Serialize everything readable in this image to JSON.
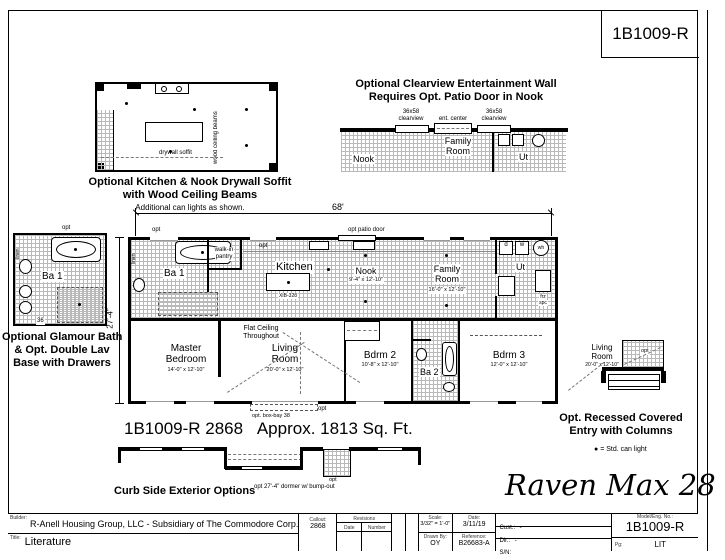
{
  "style": {
    "ink": "#000000",
    "paper": "#ffffff",
    "grid_line": "#b9b9b9"
  },
  "sheet": {
    "model_number": "1B1009-R",
    "series_name": "Raven Max 28"
  },
  "kitchen_detail": {
    "caption_1": "Optional Kitchen & Nook Drywall Soffit",
    "caption_2": "with Wood Ceiling Beams",
    "caption_3": "Additional can lights as shown.",
    "wood_beams": "wood ceiling beams",
    "drywall_soffit": "drywall soffit"
  },
  "ent_wall_detail": {
    "title_1": "Optional Clearview Entertainment Wall",
    "title_2": "Requires Opt. Patio Door in Nook",
    "clearview_l1": "36x58",
    "clearview_l2": "clearview",
    "ent_center": "ent. center",
    "clearview_r1": "36x58",
    "clearview_r2": "clearview",
    "family_1": "Family",
    "family_2": "Room",
    "nook": "Nook",
    "ut": "Ut"
  },
  "bath_detail": {
    "caption_1": "Optional Glamour Bath",
    "caption_2": "& Opt. Double Lav",
    "caption_3": "Base with Drawers",
    "room": "Ba 1",
    "opt": "opt",
    "linen": "linen",
    "dim_36": "36"
  },
  "plan": {
    "dim_width": "68'",
    "dim_depth": "27'-4\"",
    "opt_patio_door": "opt patio door",
    "opt_left": "opt",
    "opt_kitchen": "opt",
    "opt_front": "opt",
    "box_bay": "opt. box-bay 38",
    "flat_ceiling_1": "Flat Ceiling",
    "flat_ceiling_2": "Throughout",
    "ba1": "Ba 1",
    "linen": "linen",
    "pantry_1": "walk-in",
    "pantry_2": "pantry",
    "kitchen": "Kitchen",
    "island": "XIB-328",
    "nook": "Nook",
    "nook_dims": "9'-4\" x 12'-10\"",
    "family_1": "Family",
    "family_2": "Room",
    "family_dims": "16'-0\" x 12'-10\"",
    "ut": "Ut",
    "dryer": "d",
    "washer": "w",
    "water_heater": "wh",
    "frz_1": "frz",
    "frz_2": "spc",
    "master_1": "Master",
    "master_2": "Bedroom",
    "master_dims": "14'-0\" x 12'-10\"",
    "living_1": "Living",
    "living_2": "Room",
    "living_dims": "20'-0\" x 12'-10\"",
    "bdrm2": "Bdrm 2",
    "bdrm2_dims": "10'-8\" x 12'-10\"",
    "ba2": "Ba 2",
    "bdrm3": "Bdrm 3",
    "bdrm3_dims": "12'-0\" x 12'-10\"",
    "caption_model": "1B1009-R 2868",
    "caption_sqft": "Approx. 1813 Sq. Ft."
  },
  "entry_detail": {
    "caption_1": "Opt. Recessed Covered",
    "caption_2": "Entry with Columns",
    "living_1": "Living",
    "living_2": "Room",
    "living_dims": "20'-0\" x 12'-10\"",
    "opt": "opt",
    "legend_bullet": "●",
    "legend_text": "= Std. can light"
  },
  "curb_detail": {
    "caption": "Curb Side Exterior Options",
    "dormer": "opt 27'-4\" dormer w/ bump-out",
    "opt": "opt"
  },
  "title_block": {
    "builder_label": "Builder:",
    "builder": "R-Anell Housing Group, LLC - Subsidiary of The Commodore Corp.",
    "title_label": "Title:",
    "title": "Literature",
    "callout_label": "Callout:",
    "callout": "2868",
    "revisions": "Revisions",
    "rev_date": "Date",
    "rev_number": "Number",
    "scale_label": "Scale:",
    "scale": "3/32\" = 1'-0\"",
    "drawn_by_label": "Drawn By:",
    "drawn_by": "OY",
    "date_label": "Date:",
    "date": "3/11/19",
    "reference_label": "Reference:",
    "reference": "B26683-A",
    "cust_label": "Cust.:",
    "cust": "-",
    "dlr_label": "Dlr.:",
    "dlr": "-",
    "sn_label": "S/N:",
    "model_label": "Model/Eng. No.:",
    "model": "1B1009-R",
    "pg_label": "Pg:",
    "pg": "LIT"
  }
}
